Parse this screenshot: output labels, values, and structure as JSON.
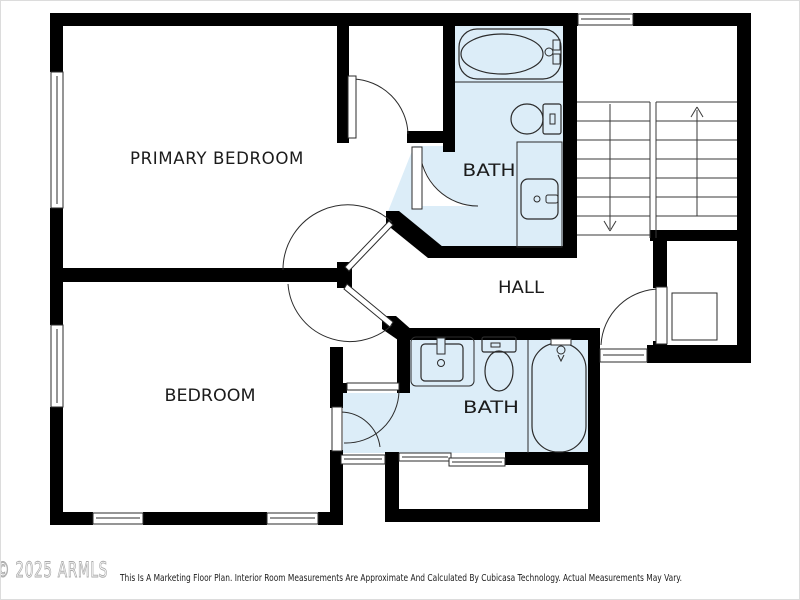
{
  "plan": {
    "type": "floor-plan",
    "rooms": [
      {
        "id": "primary-bedroom",
        "label": "PRIMARY BEDROOM"
      },
      {
        "id": "bath-upper",
        "label": "BATH"
      },
      {
        "id": "hall",
        "label": "HALL"
      },
      {
        "id": "bedroom",
        "label": "BEDROOM"
      },
      {
        "id": "bath-lower",
        "label": "BATH"
      }
    ],
    "colors": {
      "wall": "#000000",
      "bath_floor": "#dcedf8",
      "line": "#2b2b2b",
      "label_text": "#1b1b1b",
      "watermark_outline": "#a9a9a9"
    },
    "stairs": {
      "flights": 2,
      "up_arrow": "up",
      "down_arrow": "down"
    }
  },
  "footer": {
    "watermark": "© 2025 ARMLS",
    "disclaimer": "This Is A Marketing Floor Plan. Interior Room Measurements Are Approximate And Calculated By Cubicasa Technology. Actual Measurements May Vary."
  }
}
